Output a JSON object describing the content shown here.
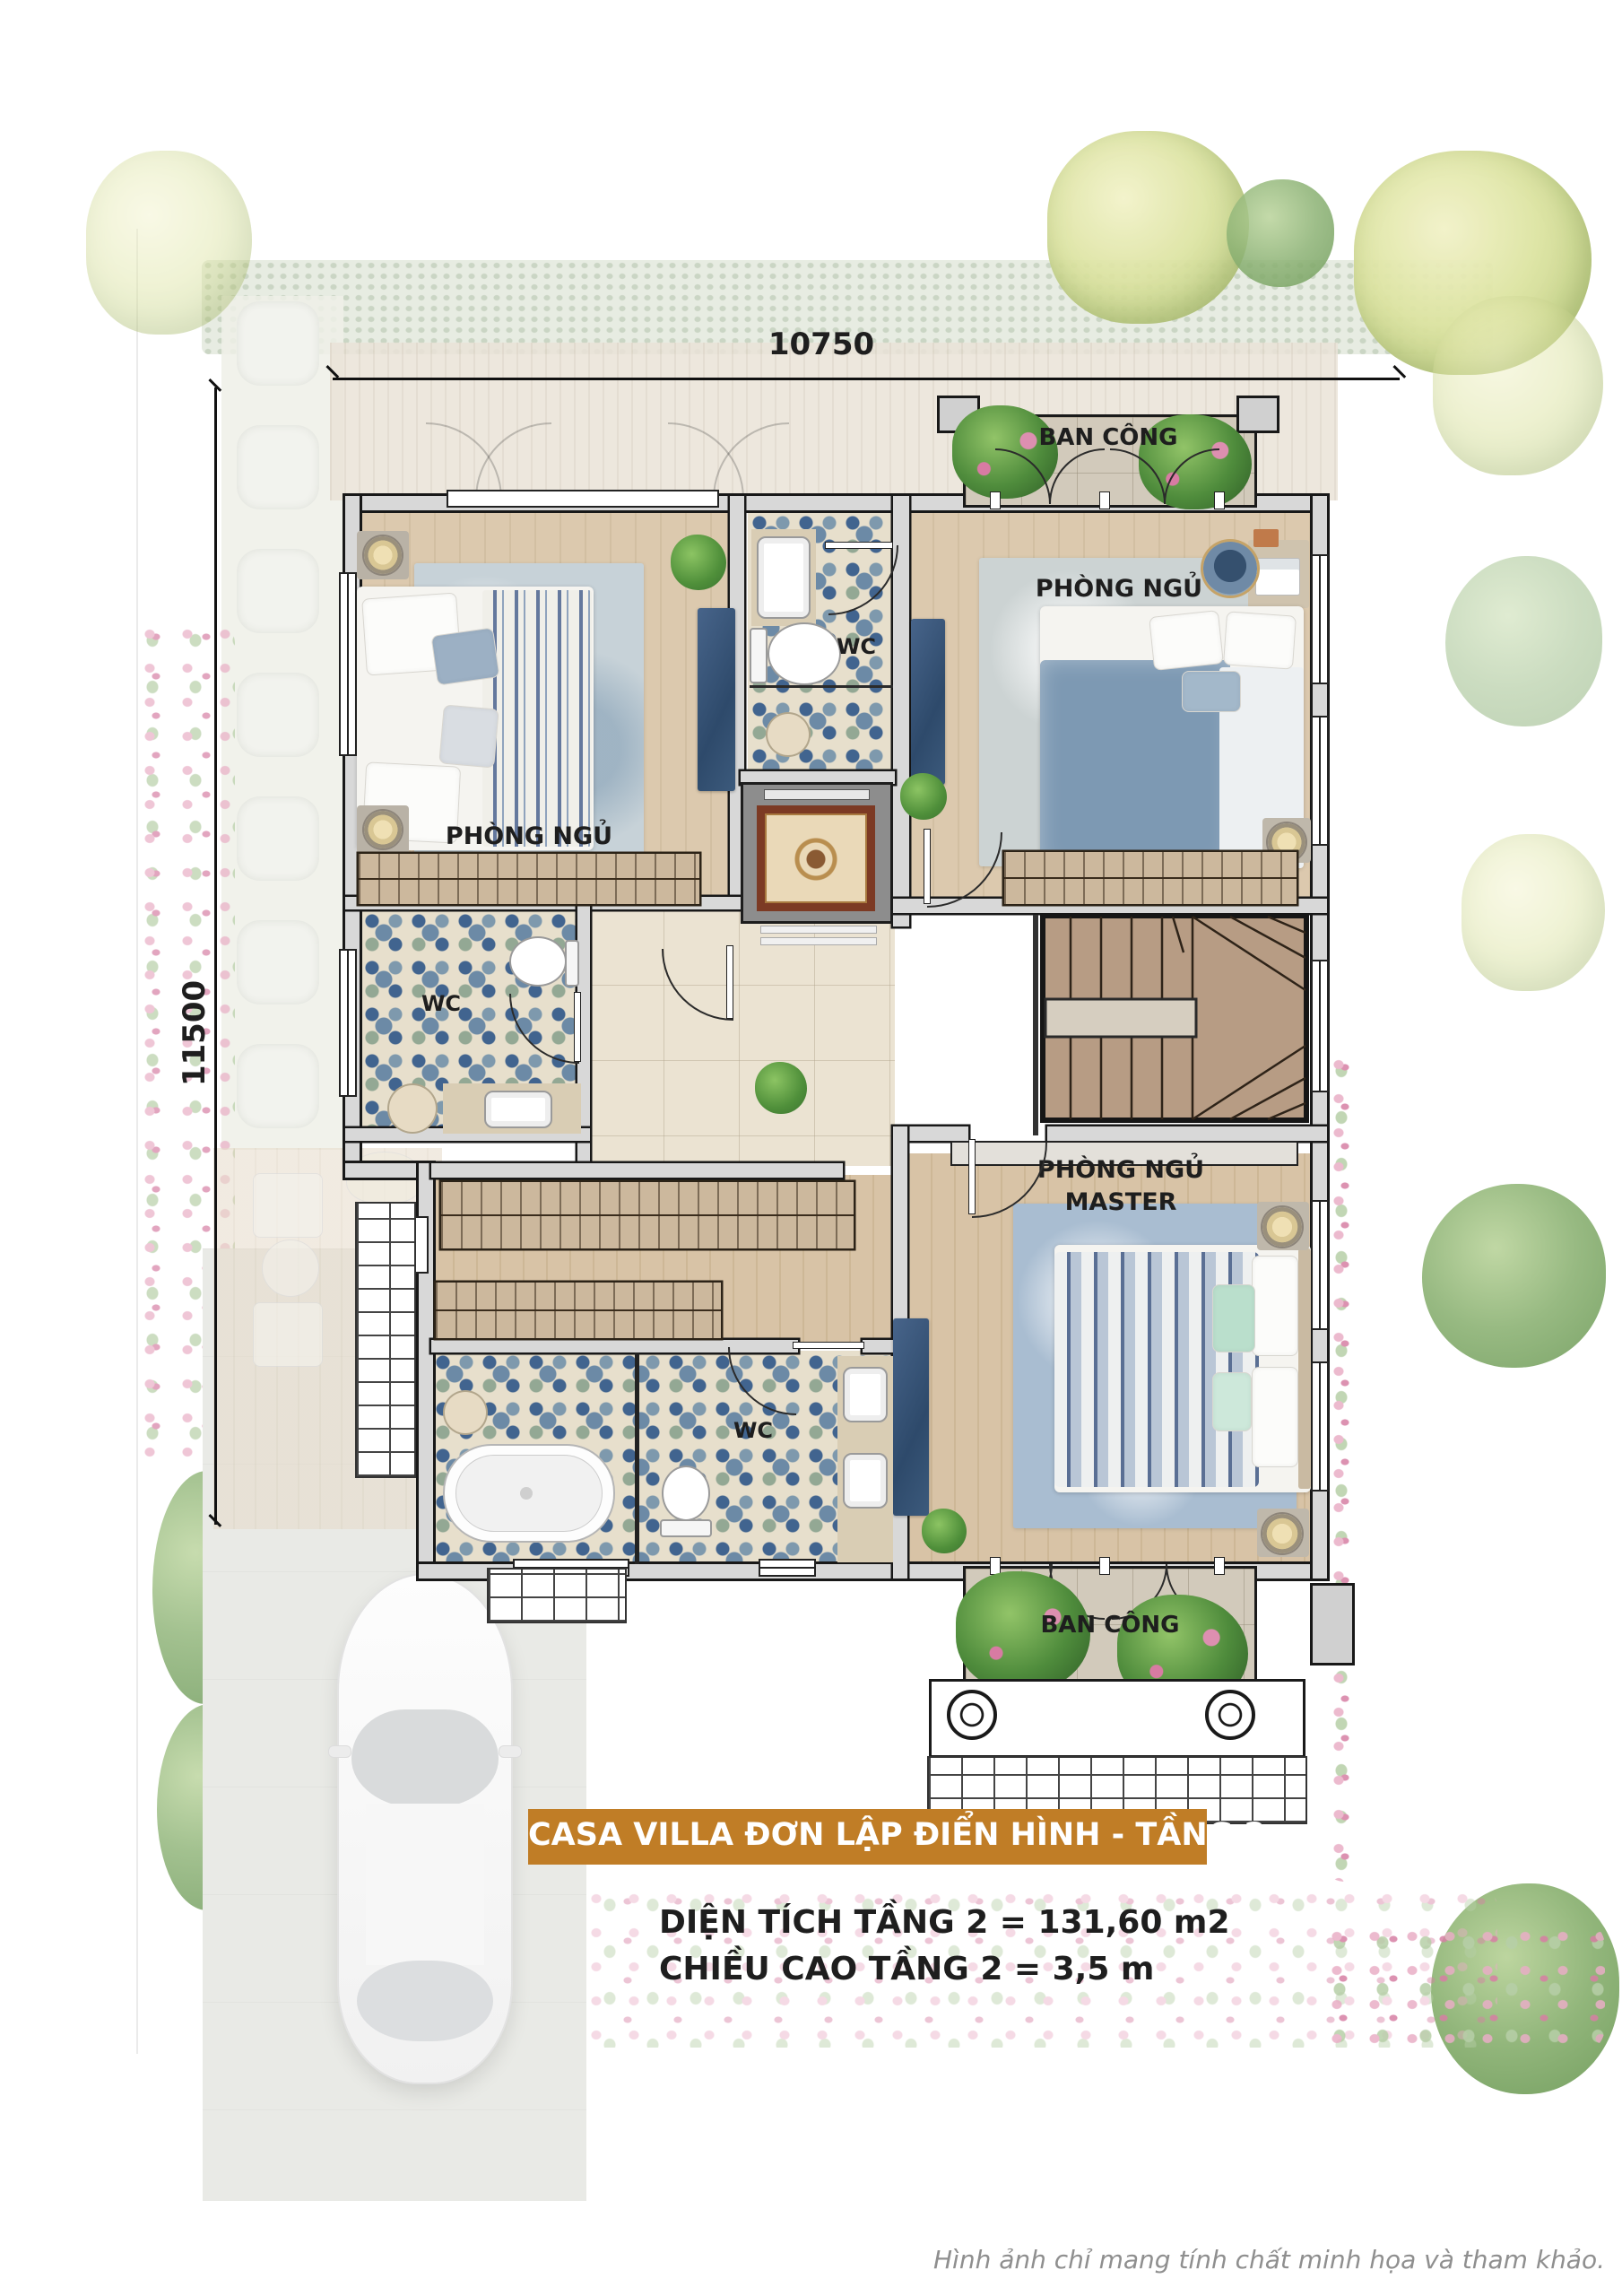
{
  "floor_plan": {
    "dimensions": {
      "width": "10750",
      "height": "11500"
    },
    "rooms": {
      "bedroom_top_left": "PHÒNG NGỦ",
      "bedroom_top_right": "PHÒNG NGỦ",
      "master_bedroom": {
        "line1": "PHÒNG NGỦ",
        "line2": "MASTER"
      },
      "wc_top": "WC",
      "wc_left": "WC",
      "wc_master": "WC",
      "balcony_top": "BAN CÔNG",
      "balcony_bottom": "BAN CÔNG"
    }
  },
  "caption": {
    "banner": "CASA VILLA ĐƠN LẬP ĐIỂN HÌNH  - TẦNG 2",
    "area_line": "DIỆN TÍCH TẦNG 2  = 131,60 m2",
    "height_line": "CHIỀU CAO TẦNG 2 = 3,5 m"
  },
  "footer": {
    "disclaimer": "Hình ảnh chỉ mang tính chất minh họa và tham khảo."
  },
  "colors": {
    "banner_bg": "#c07d26",
    "wall_outline": "#181818",
    "wall_fill": "#d8d8d8",
    "tile_blue": "#41648f",
    "wood_floor": "#dcc9ae",
    "text": "#1e1e1e"
  }
}
